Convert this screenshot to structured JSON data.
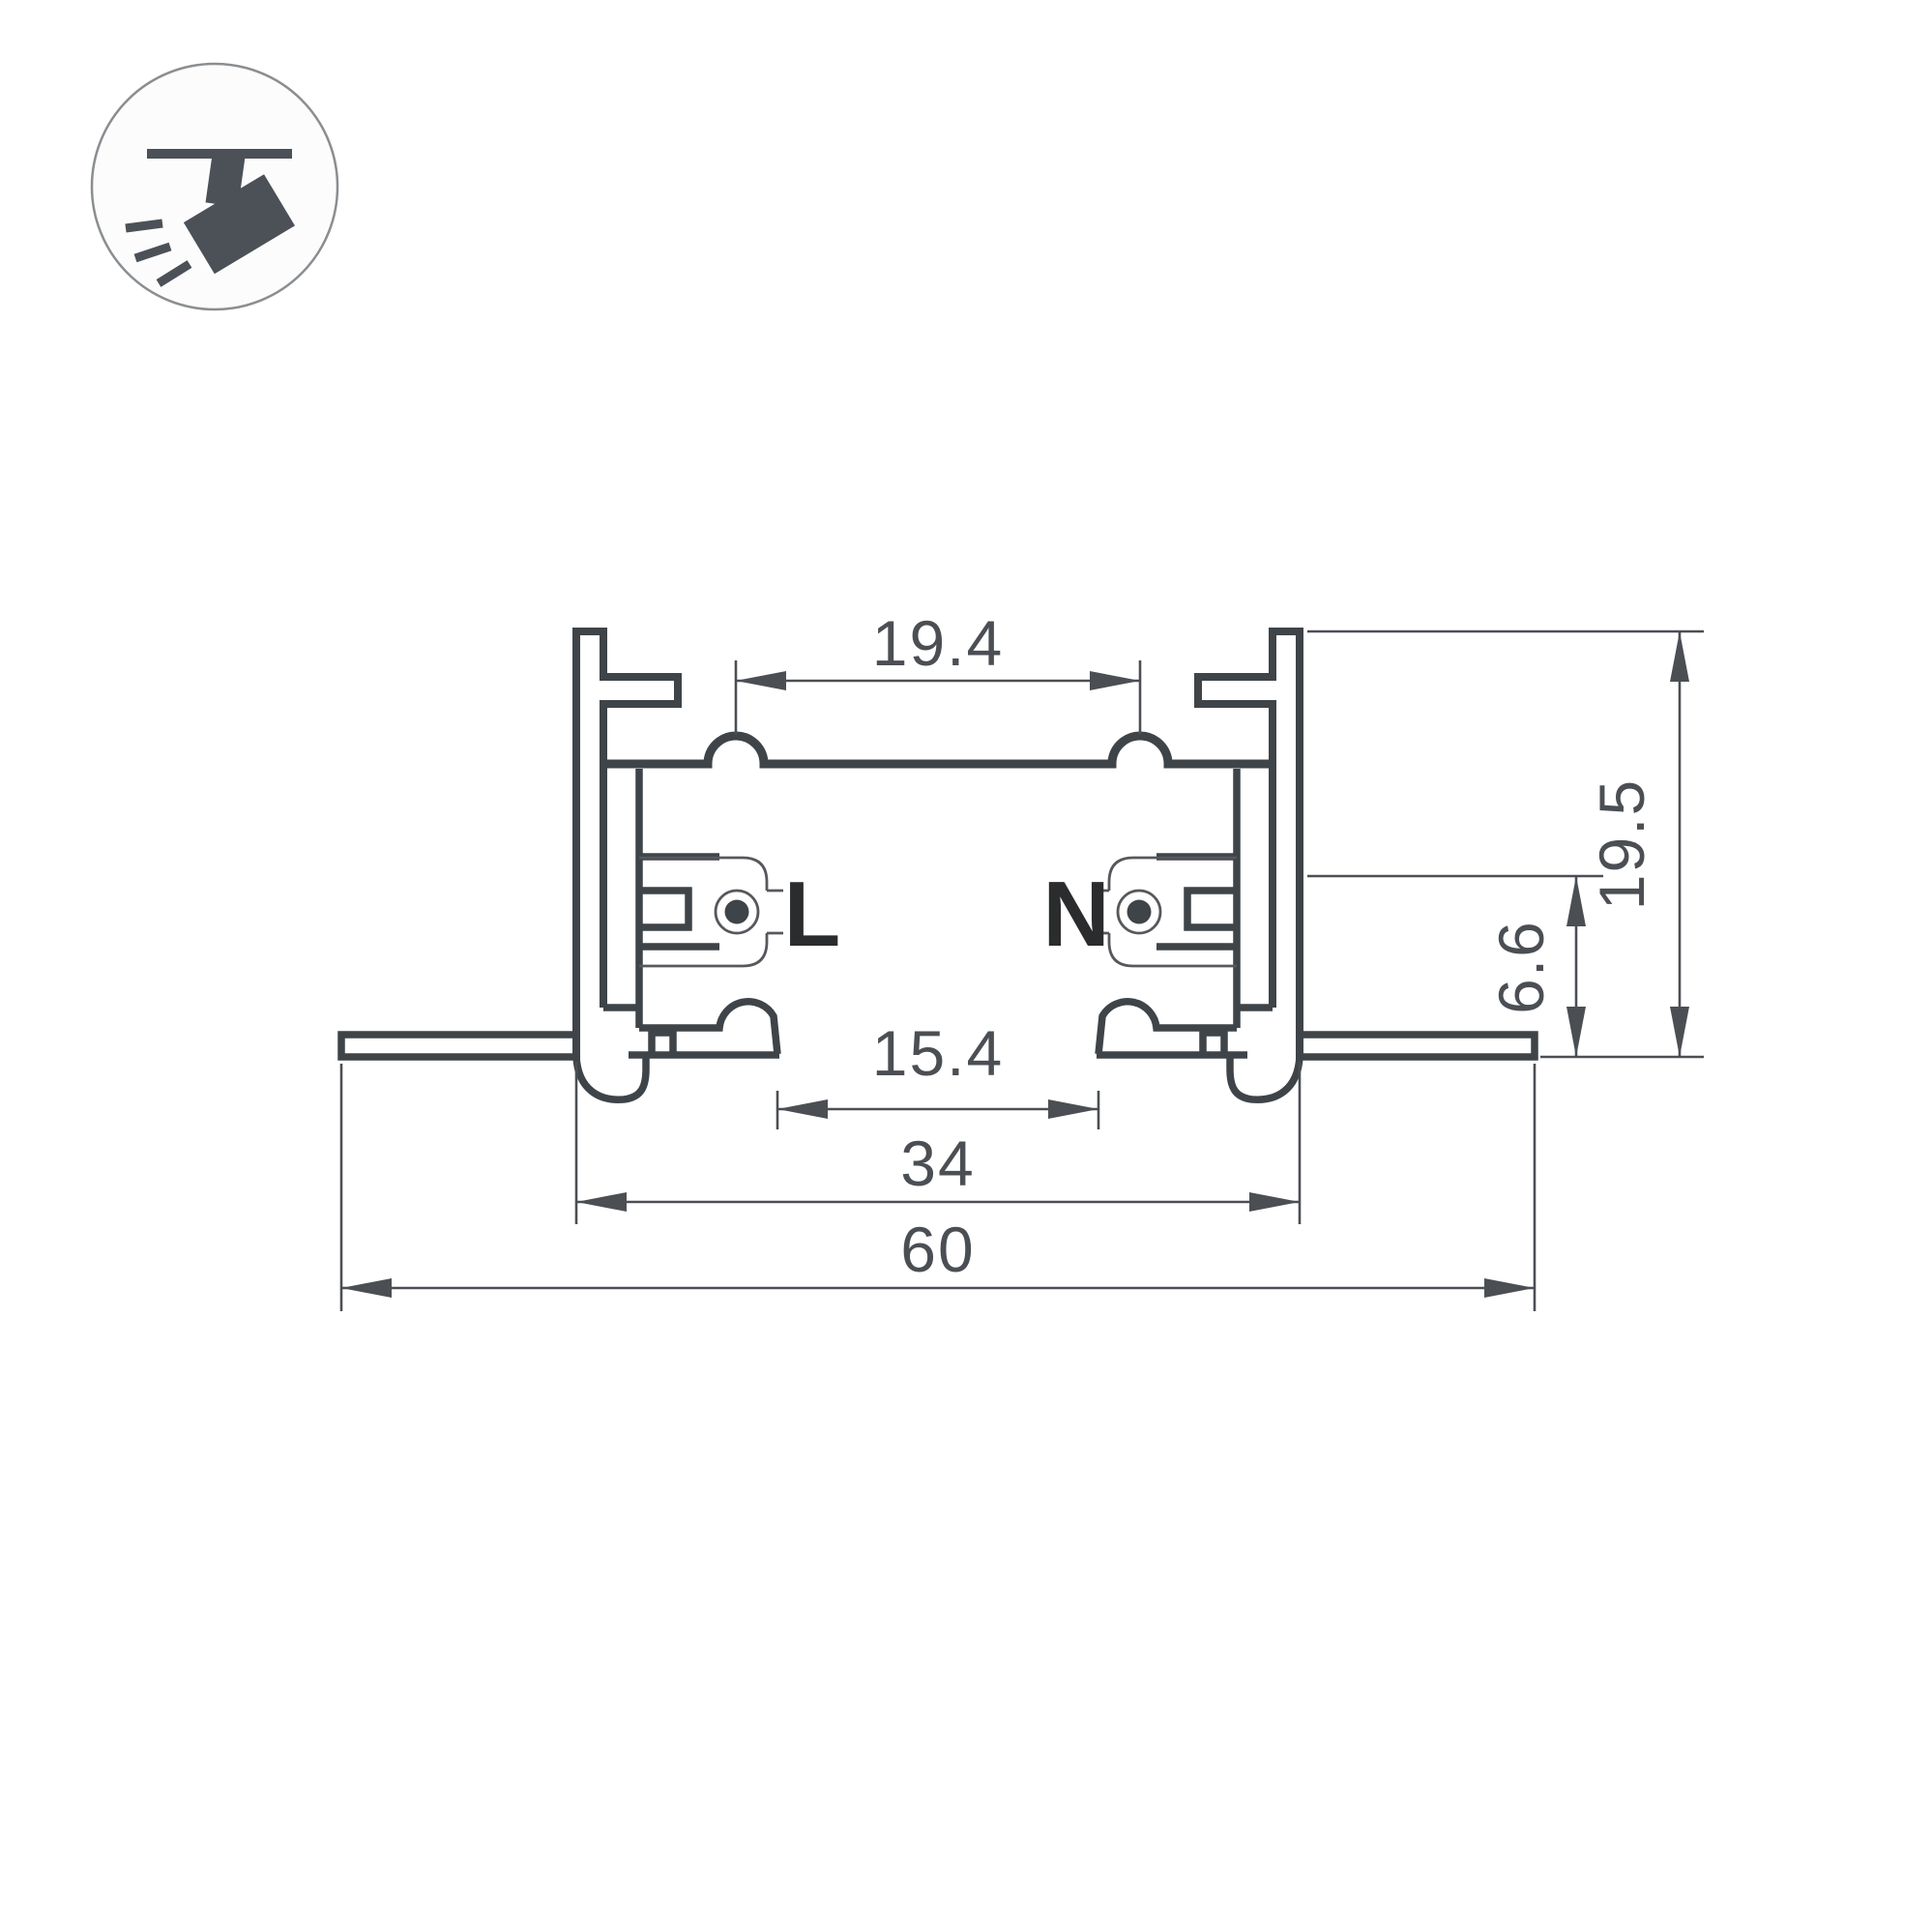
{
  "icon": {
    "name": "track-spotlight",
    "description": "ceiling-mounted track spotlight pictogram"
  },
  "labels": {
    "live": "L",
    "neutral": "N"
  },
  "dimensions": {
    "top_inner_width": "19.4",
    "bottom_opening_width": "15.4",
    "body_width": "34",
    "overall_width": "60",
    "recess_depth": "6.6",
    "overall_height": "19.5"
  },
  "colors": {
    "profile_line": "#3f4449",
    "dimension_line": "#4b4f54",
    "conductor_label": "#2a2c2e",
    "icon_glyph": "#4b5157",
    "background": "#ffffff"
  }
}
